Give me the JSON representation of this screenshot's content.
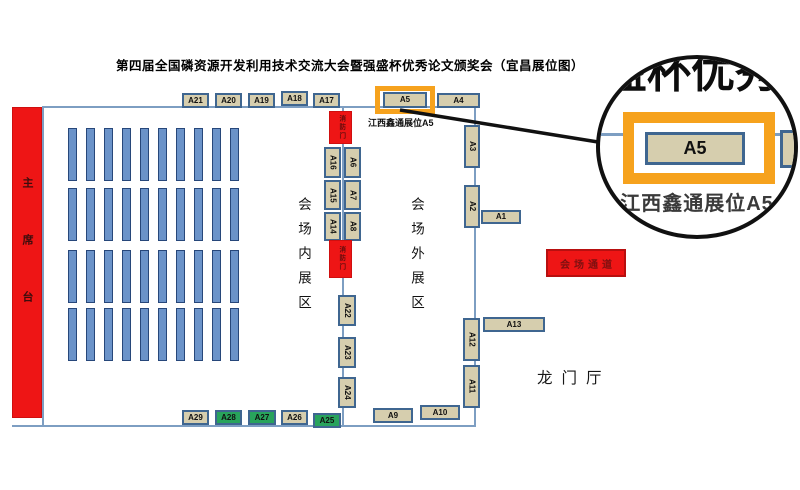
{
  "title": "第四届全国磷资源开发利用技术交流大会暨强盛杯优秀论文颁奖会（宜昌展位图）",
  "stage_label": "主席台",
  "zones": {
    "inner": "会场内展区",
    "outer": "会场外展区"
  },
  "fire_door_label": "消防门",
  "passage_label": "会场通道",
  "lobby_label": "龙门厅",
  "a5_annotation": "江西鑫通展位A5",
  "magnifier": {
    "title_fragment": "盛杯优秀",
    "booth_id": "A5",
    "caption": "江西鑫通展位A5"
  },
  "colors": {
    "booth_fill": "#d6ceae",
    "booth_border": "#3f6690",
    "green_booth": "#28a35c",
    "red": "#ee1515",
    "seat_fill": "#6b93c9",
    "wall": "#7d9ec2",
    "highlight_orange": "#f6a21d"
  },
  "floorplan": {
    "booths": [
      {
        "id": "A21",
        "x": 182,
        "y": 93,
        "w": 27,
        "h": 15,
        "orient": "h",
        "color": "tan"
      },
      {
        "id": "A20",
        "x": 215,
        "y": 93,
        "w": 27,
        "h": 15,
        "orient": "h",
        "color": "tan"
      },
      {
        "id": "A19",
        "x": 248,
        "y": 93,
        "w": 27,
        "h": 15,
        "orient": "h",
        "color": "tan"
      },
      {
        "id": "A18",
        "x": 281,
        "y": 91,
        "w": 27,
        "h": 15,
        "orient": "h",
        "color": "tan"
      },
      {
        "id": "A17",
        "x": 313,
        "y": 93,
        "w": 27,
        "h": 15,
        "orient": "h",
        "color": "tan"
      },
      {
        "id": "A5",
        "x": 383,
        "y": 92,
        "w": 44,
        "h": 16,
        "orient": "h",
        "color": "tan",
        "highlight": true
      },
      {
        "id": "A4",
        "x": 437,
        "y": 93,
        "w": 43,
        "h": 15,
        "orient": "h",
        "color": "tan"
      },
      {
        "id": "A16",
        "x": 324,
        "y": 147,
        "w": 17,
        "h": 31,
        "orient": "v",
        "color": "tan"
      },
      {
        "id": "A6",
        "x": 344,
        "y": 147,
        "w": 17,
        "h": 31,
        "orient": "v",
        "color": "tan"
      },
      {
        "id": "A15",
        "x": 324,
        "y": 180,
        "w": 17,
        "h": 30,
        "orient": "v",
        "color": "tan"
      },
      {
        "id": "A7",
        "x": 344,
        "y": 180,
        "w": 17,
        "h": 30,
        "orient": "v",
        "color": "tan"
      },
      {
        "id": "A14",
        "x": 324,
        "y": 212,
        "w": 17,
        "h": 29,
        "orient": "v",
        "color": "tan"
      },
      {
        "id": "A8",
        "x": 344,
        "y": 212,
        "w": 17,
        "h": 29,
        "orient": "v",
        "color": "tan"
      },
      {
        "id": "A22",
        "x": 338,
        "y": 295,
        "w": 18,
        "h": 31,
        "orient": "v",
        "color": "tan"
      },
      {
        "id": "A23",
        "x": 338,
        "y": 337,
        "w": 18,
        "h": 31,
        "orient": "v",
        "color": "tan"
      },
      {
        "id": "A24",
        "x": 338,
        "y": 377,
        "w": 18,
        "h": 31,
        "orient": "v",
        "color": "tan"
      },
      {
        "id": "A3",
        "x": 464,
        "y": 125,
        "w": 16,
        "h": 43,
        "orient": "v",
        "color": "tan"
      },
      {
        "id": "A2",
        "x": 464,
        "y": 185,
        "w": 16,
        "h": 43,
        "orient": "v",
        "color": "tan"
      },
      {
        "id": "A1",
        "x": 481,
        "y": 210,
        "w": 40,
        "h": 14,
        "orient": "h",
        "color": "tan"
      },
      {
        "id": "A13",
        "x": 483,
        "y": 317,
        "w": 62,
        "h": 15,
        "orient": "h",
        "color": "tan"
      },
      {
        "id": "A12",
        "x": 463,
        "y": 318,
        "w": 17,
        "h": 43,
        "orient": "v",
        "color": "tan"
      },
      {
        "id": "A11",
        "x": 463,
        "y": 365,
        "w": 17,
        "h": 43,
        "orient": "v",
        "color": "tan"
      },
      {
        "id": "A29",
        "x": 182,
        "y": 410,
        "w": 27,
        "h": 15,
        "orient": "h",
        "color": "tan"
      },
      {
        "id": "A28",
        "x": 215,
        "y": 410,
        "w": 27,
        "h": 15,
        "orient": "h",
        "color": "green"
      },
      {
        "id": "A27",
        "x": 248,
        "y": 410,
        "w": 28,
        "h": 15,
        "orient": "h",
        "color": "green"
      },
      {
        "id": "A26",
        "x": 281,
        "y": 410,
        "w": 27,
        "h": 15,
        "orient": "h",
        "color": "tan"
      },
      {
        "id": "A25",
        "x": 313,
        "y": 413,
        "w": 28,
        "h": 15,
        "orient": "h",
        "color": "green"
      },
      {
        "id": "A9",
        "x": 373,
        "y": 408,
        "w": 40,
        "h": 15,
        "orient": "h",
        "color": "tan"
      },
      {
        "id": "A10",
        "x": 420,
        "y": 405,
        "w": 40,
        "h": 15,
        "orient": "h",
        "color": "tan"
      }
    ],
    "fire_doors": [
      {
        "x": 329,
        "y": 111,
        "w": 23,
        "h": 33
      },
      {
        "x": 329,
        "y": 240,
        "w": 23,
        "h": 38
      }
    ],
    "seats": {
      "rows": [
        128,
        188,
        250,
        308
      ],
      "cols": 10,
      "col_x0": 68,
      "col_dx": 18,
      "bar_w": 9,
      "bar_h": 53
    }
  }
}
